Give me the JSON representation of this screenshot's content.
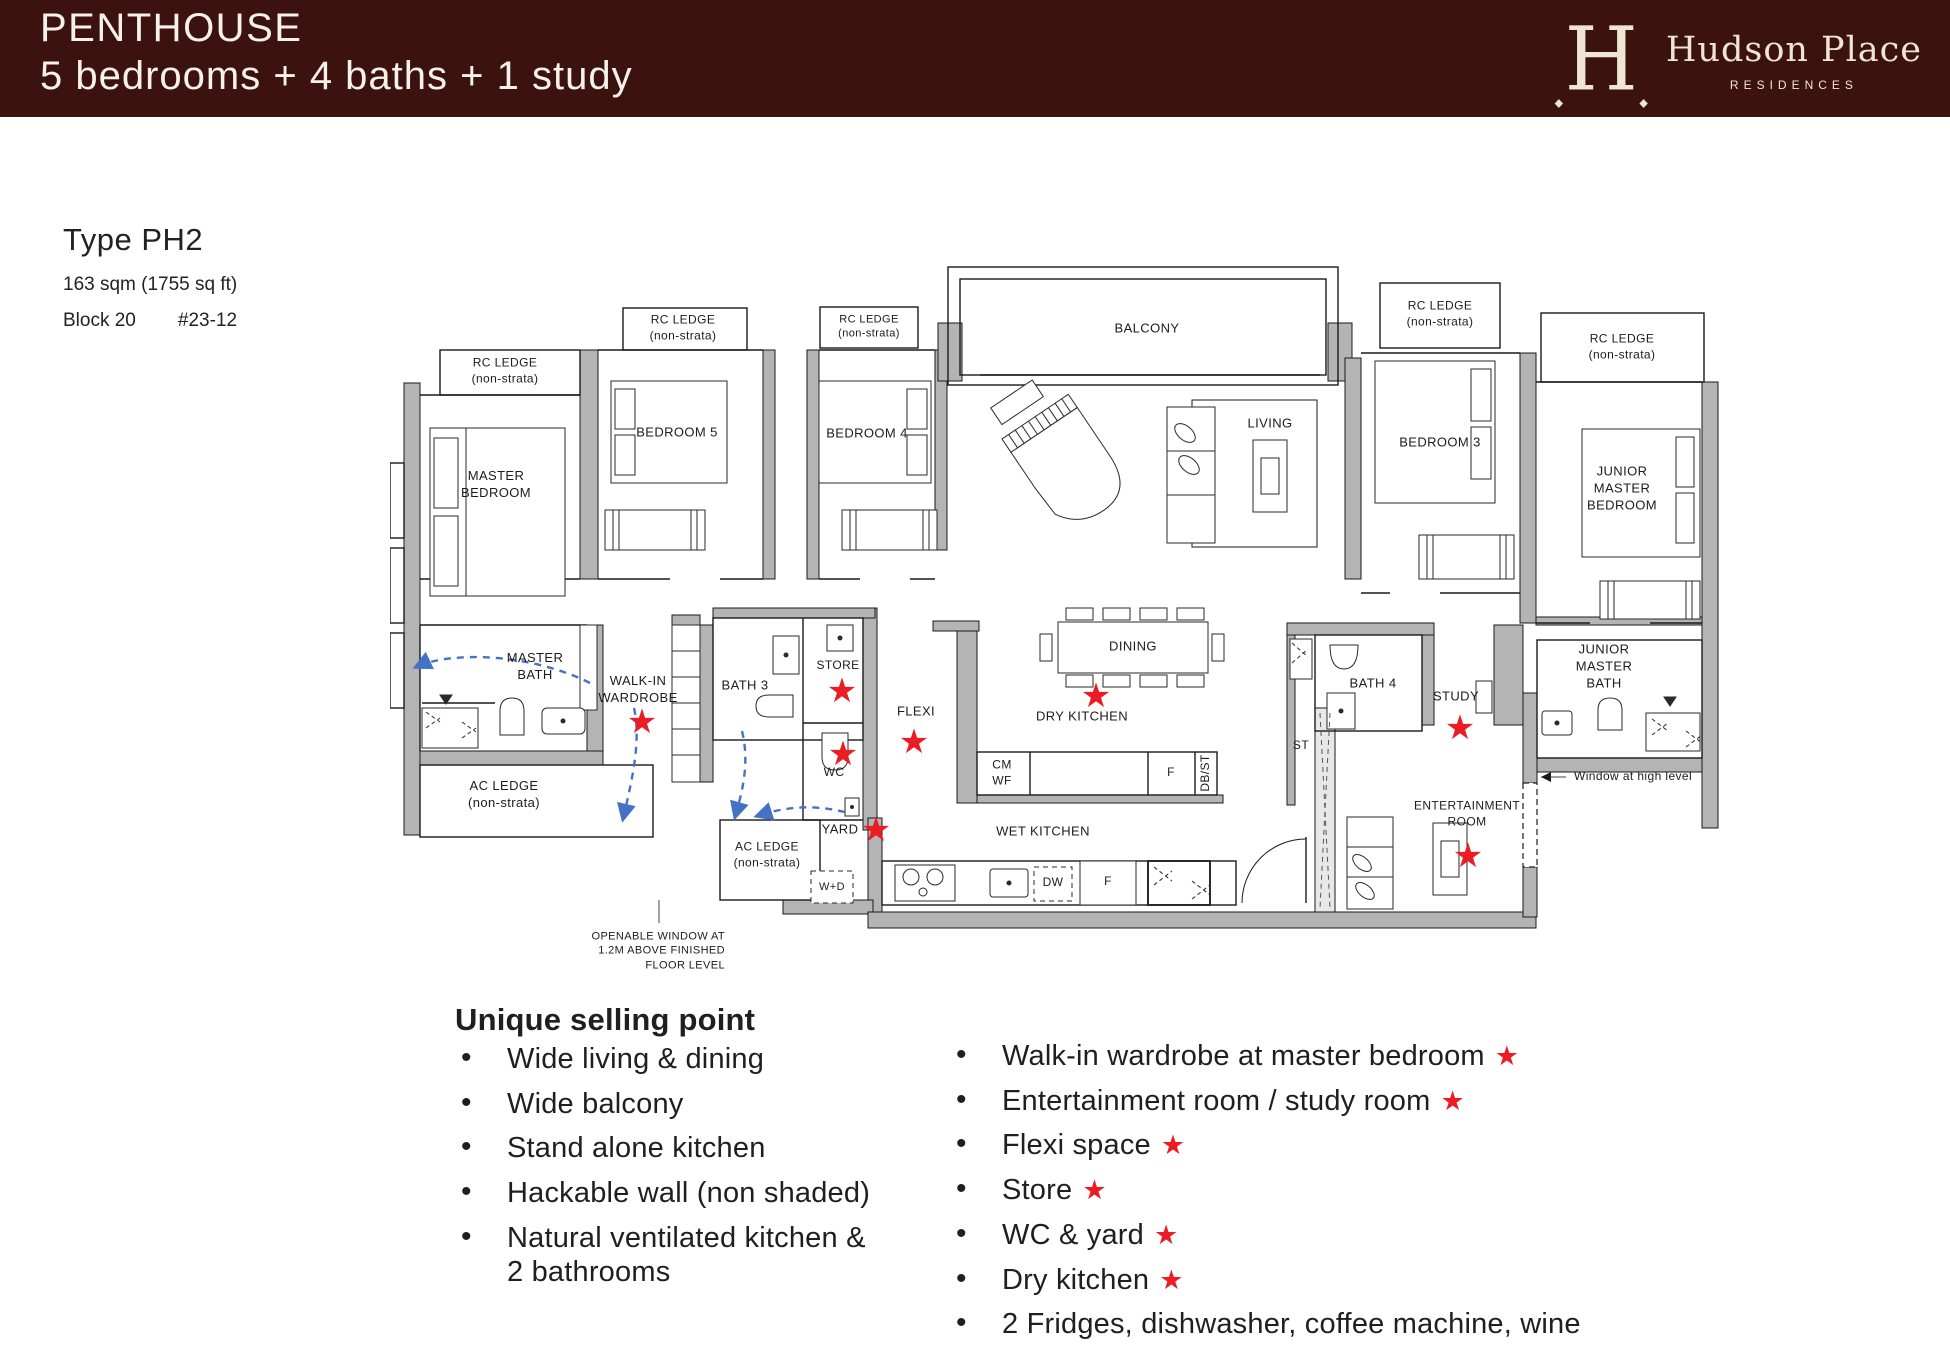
{
  "header": {
    "title": "PENTHOUSE",
    "subtitle": "5 bedrooms + 4 baths + 1 study",
    "logo": {
      "monogram": "H",
      "name": "Hudson Place",
      "tagline": "RESIDENCES"
    }
  },
  "unit": {
    "type_label": "Type PH2",
    "area": "163 sqm (1755 sq ft)",
    "block": "Block 20",
    "unit_no": "#23-12"
  },
  "plan": {
    "labels": {
      "rc_ledge": "RC LEDGE\n(non-strata)",
      "balcony": "BALCONY",
      "master_bedroom": "MASTER\nBEDROOM",
      "bedroom5": "BEDROOM 5",
      "bedroom4": "BEDROOM 4",
      "living": "LIVING",
      "bedroom3": "BEDROOM 3",
      "junior_master_bedroom": "JUNIOR\nMASTER\nBEDROOM",
      "master_bath": "MASTER\nBATH",
      "walk_in_wardrobe": "WALK-IN\nWARDROBE",
      "bath3": "BATH 3",
      "store": "STORE",
      "wc": "WC",
      "flexi": "FLEXI",
      "dining": "DINING",
      "dry_kitchen": "DRY KITCHEN",
      "wet_kitchen": "WET KITCHEN",
      "cm_wf": "CM\nWF",
      "fridge": "F",
      "db_st": "DB/ST",
      "st": "ST",
      "bath4": "BATH 4",
      "study": "STUDY",
      "junior_master_bath": "JUNIOR\nMASTER\nBATH",
      "ac_ledge": "AC LEDGE\n(non-strata)",
      "yard": "YARD",
      "wd": "W+D",
      "dw": "DW",
      "entertainment_room": "ENTERTAINMENT\nROOM",
      "window_high": "Window at high level",
      "openable_window": "OPENABLE WINDOW AT\n1.2M ABOVE FINISHED\nFLOOR LEVEL"
    }
  },
  "usp": {
    "heading": "Unique selling point",
    "left": [
      "Wide living & dining",
      "Wide balcony",
      "Stand alone kitchen",
      "Hackable wall (non shaded)",
      "Natural ventilated kitchen &\n2 bathrooms"
    ],
    "right": [
      {
        "text": "Walk-in wardrobe at master bedroom",
        "star": true
      },
      {
        "text": "Entertainment room / study room",
        "star": true
      },
      {
        "text": "Flexi space",
        "star": true
      },
      {
        "text": "Store",
        "star": true
      },
      {
        "text": "WC & yard",
        "star": true
      },
      {
        "text": "Dry kitchen",
        "star": true
      },
      {
        "text": "2 Fridges, dishwasher, coffee machine, wine",
        "star": false
      }
    ]
  },
  "colors": {
    "header_bg": "#3C120E",
    "logo_cream": "#EFE5D3",
    "star_red": "#EC1C24",
    "arrow_blue": "#4472C4",
    "wall_gray": "#B4B4B4"
  }
}
